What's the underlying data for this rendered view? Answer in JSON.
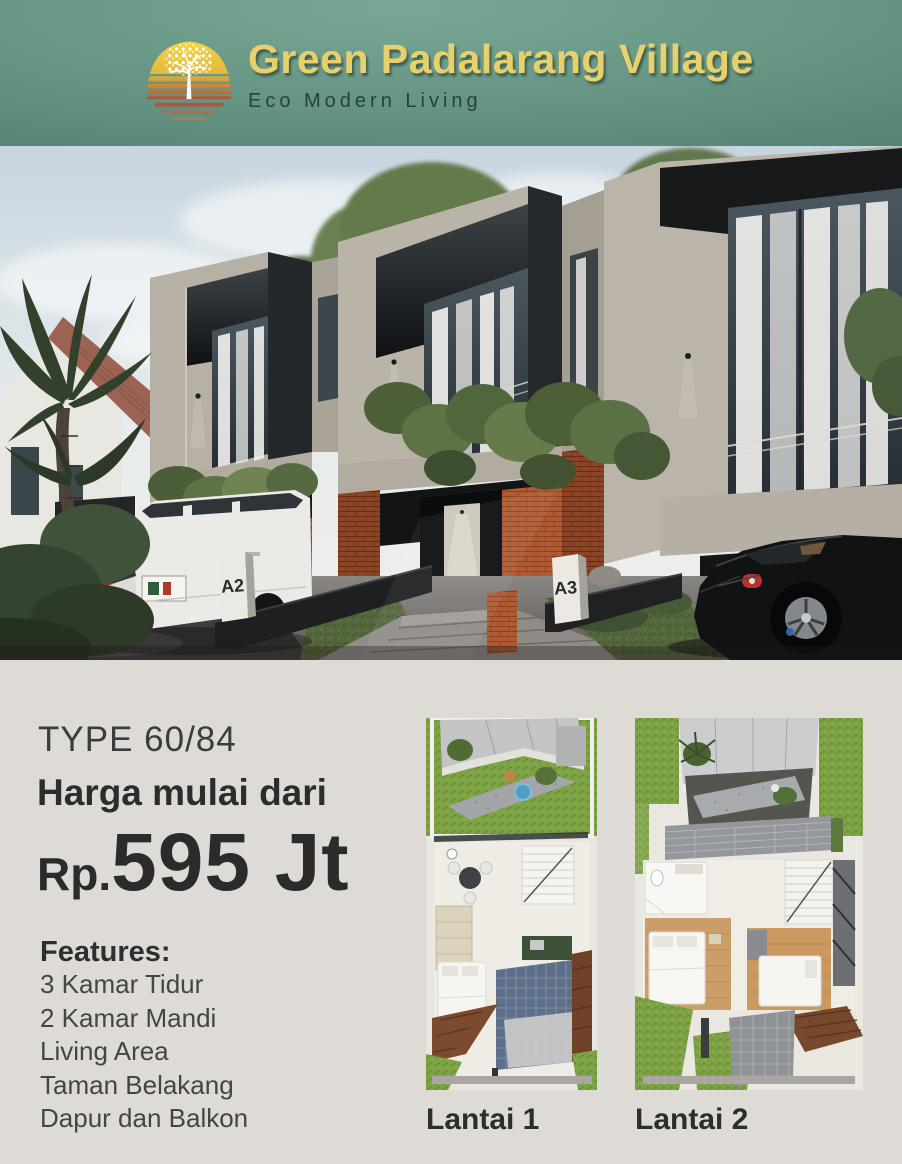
{
  "header": {
    "title": "Green Padalarang Village",
    "subtitle": "Eco Modern Living",
    "logo_icon": "sun-tree-logo",
    "colors": {
      "background": "#5d8d7d",
      "title_gold": "#e8d16c",
      "subtitle_dark": "#25433a"
    }
  },
  "photo": {
    "description": "Modern two-storey brick townhouse row with carports, white SUV and black sports car",
    "markers": [
      {
        "label": "A2"
      },
      {
        "label": "A3"
      }
    ]
  },
  "info": {
    "type_label": "TYPE 60/84",
    "price_lead": "Harga mulai dari",
    "price_currency": "Rp.",
    "price_value": "595 Jt",
    "features_title": "Features:",
    "features": [
      "3 Kamar Tidur",
      "2 Kamar Mandi",
      "Living Area",
      "Taman Belakang",
      "Dapur dan Balkon"
    ],
    "colors": {
      "background": "#dedbd6",
      "text": "#2e2e2e"
    }
  },
  "plans": [
    {
      "label": "Lantai 1"
    },
    {
      "label": "Lantai 2"
    }
  ]
}
